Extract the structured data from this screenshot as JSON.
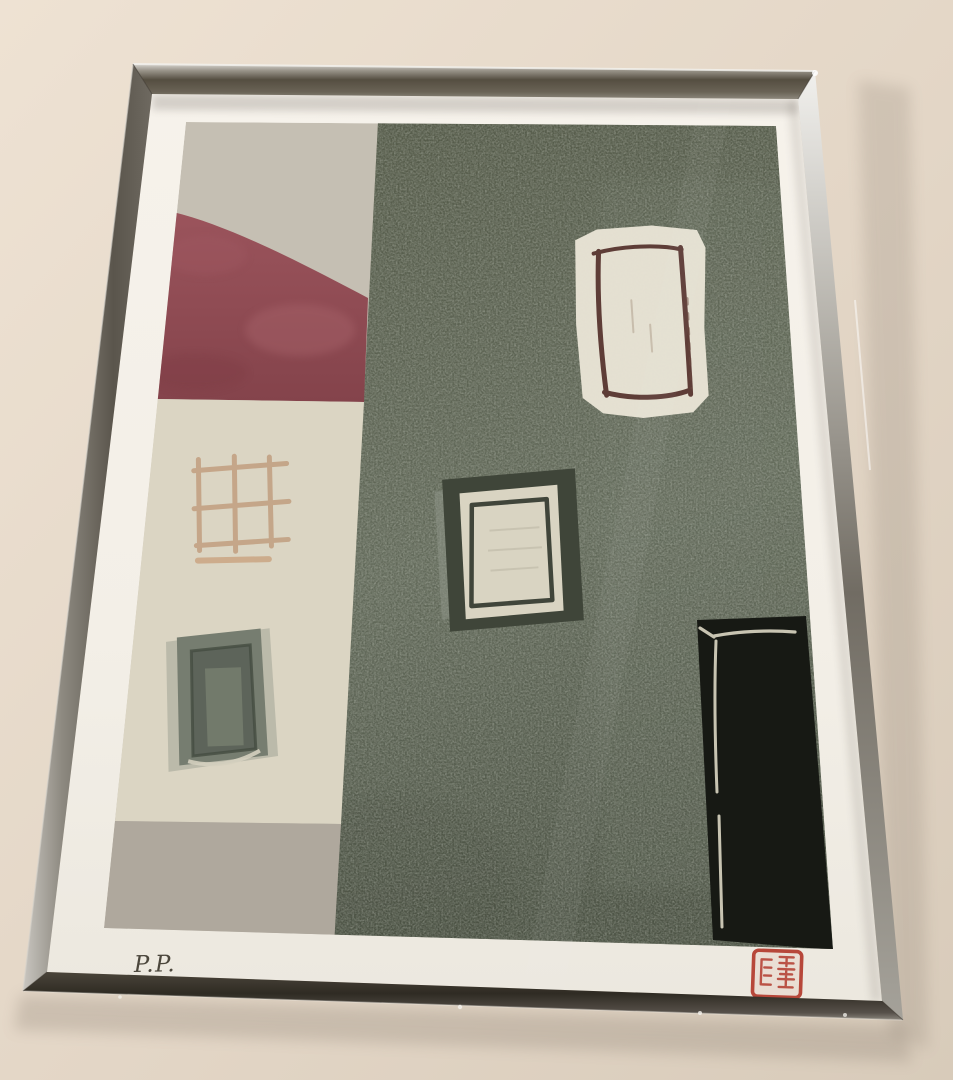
{
  "photo": {
    "signature": "P.P.",
    "palette": {
      "wall_light": "#eee2d3",
      "wall_mid": "#e3d6c6",
      "wall_dark": "#d8cbba",
      "paper_top": "#f6f2eb",
      "paper_mid": "#f3efe7",
      "paper_low": "#ece8df",
      "sky_grey": "#c5bfb3",
      "roof_red_light": "#9b545c",
      "roof_red_dark": "#84434b",
      "house_cream": "#dbd5c3",
      "ground_grey": "#afa89d",
      "green_top": "#555a48",
      "green_mid": "#676e5e",
      "green_dark": "#4d5345",
      "window_white": "#e8e3d5",
      "window_maroon": "#5e3d37",
      "window_surround_dark": "#3f4539",
      "window_pane_white": "#d9d4c2",
      "window_pane_outline": "#2f352b",
      "door_black": "#171914",
      "door_line_cream": "#d8d3c0",
      "lattice_tan": "#c2a183",
      "small_window_grey": "#767d70",
      "small_window_dark": "#5d645a",
      "seal_red": "#b7473a",
      "pencil_grey": "#4b463c",
      "frame_edge_bright": "#f4f3ef"
    }
  }
}
